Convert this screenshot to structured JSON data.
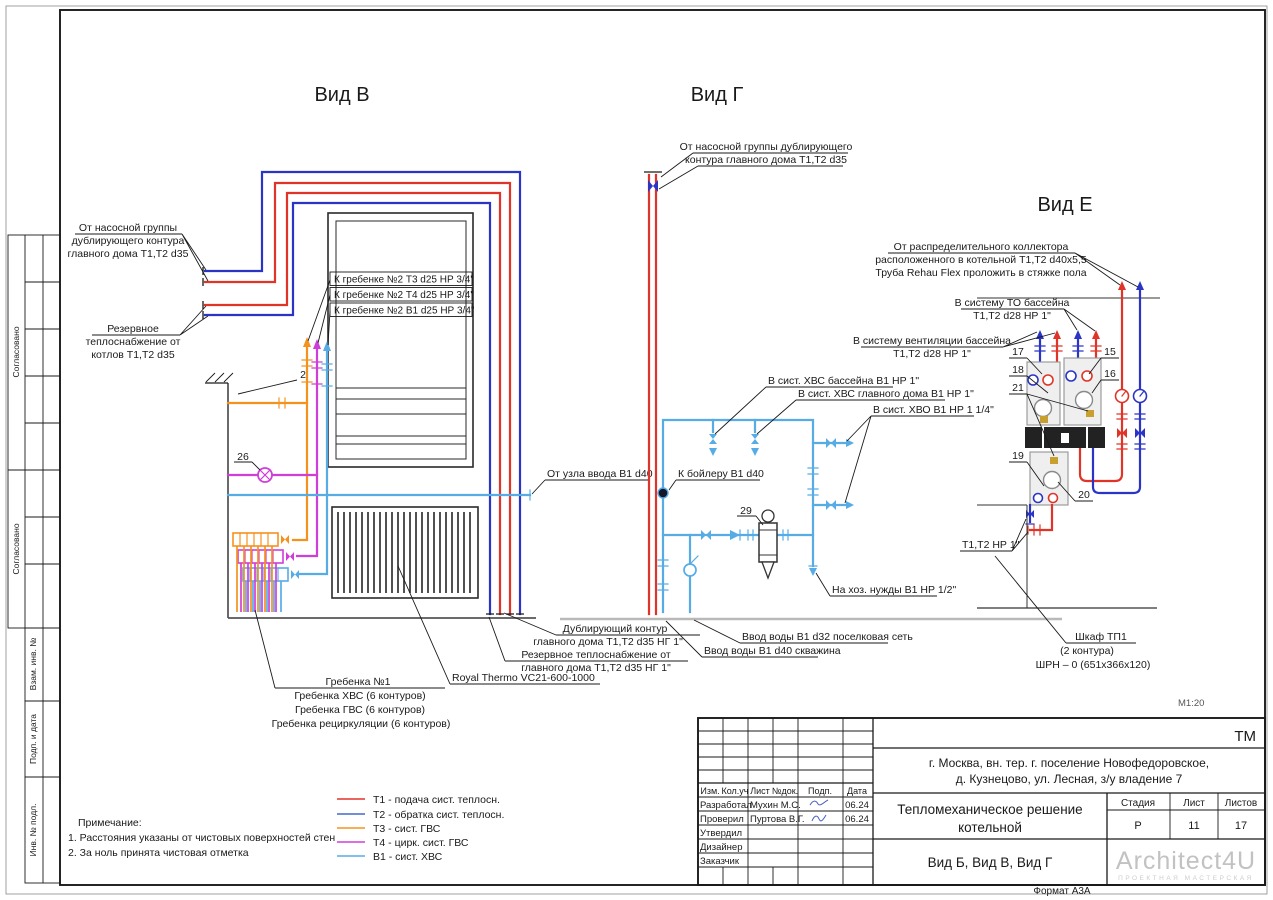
{
  "sheet": {
    "scale_note": "М1:20",
    "format_note": "Формат А3А"
  },
  "sidebar": {
    "agreed1": "Согласовано",
    "agreed2": "Согласовано",
    "vzam": "Взам. инв. №",
    "podp": "Подп. и дата",
    "inv": "Инв. № подл."
  },
  "vid_v": {
    "title": "Вид В",
    "pump_group": [
      "От насосной группы",
      "дублирующего контура",
      "главного дома Т1,Т2 d35"
    ],
    "reserve_boilers": [
      "Резервное",
      "теплоснабжение от",
      "котлов Т1,Т2 d35"
    ],
    "greb_t3": "К гребенке №2 Т3 d25 НР 3/4\"",
    "greb_t4": "К гребенке №2 Т4 d25 НР 3/4\"",
    "greb_b1": "К гребенке №2 В1 d25 НР 3/4\"",
    "num_wall": "2",
    "num_pump": "26",
    "uzel": "От узла ввода В1 d40",
    "dubl": [
      "Дублирующий контур",
      "главного дома Т1,Т2 d35 НГ 1\""
    ],
    "reserve_main": [
      "Резервное теплоснабжение от",
      "главного дома Т1,Т2 d35 НГ 1\""
    ],
    "radiator": "Royal Thermo VC21-600-1000",
    "manifold": [
      "Гребенка №1",
      "Гребенка ХВС (6 контуров)",
      "Гребенка ГВС (6 контуров)",
      "Гребенка рециркуляции (6 контуров)"
    ]
  },
  "vid_g": {
    "title": "Вид Г",
    "from_pump": [
      "От насосной группы дублирующего",
      "контура главного дома Т1,Т2 d35"
    ],
    "hvs_pool": "В сист. ХВС бассейна В1 НР 1\"",
    "hvs_main": "В сист. ХВС главного дома В1 НР 1\"",
    "hvo": "В сист. ХВО В1 НР 1 1/4\"",
    "boiler": "К бойлеру В1 d40",
    "num_filter": "29",
    "hoz": "На хоз. нужды В1 НР 1/2\"",
    "vvod_d32": "Ввод воды В1 d32 поселковая сеть",
    "vvod_d40": "Ввод воды В1 d40 скважина"
  },
  "vid_e": {
    "title": "Вид Е",
    "collector": [
      "От распределительного коллектора",
      "расположенного в котельной Т1,Т2 d40х5,5",
      "Труба Rehau Flex проложить в стяжке пола"
    ],
    "to_pool": [
      "В систему ТО бассейна",
      "Т1,Т2 d28 НР 1\""
    ],
    "vent_pool": [
      "В систему вентиляции бассейна",
      "Т1,Т2 d28 НР 1\""
    ],
    "n15": "15",
    "n16": "16",
    "n17": "17",
    "n18": "18",
    "n19": "19",
    "n20": "20",
    "n21": "21",
    "t1t2": "Т1,Т2 НР 1\"",
    "shkaf": [
      "Шкаф ТП1",
      "(2 контура)",
      "ШРН – 0 (651х366х120)"
    ]
  },
  "legend": {
    "items": [
      {
        "color": "#e03428",
        "text": "Т1 - подача сист. теплосн."
      },
      {
        "color": "#4768c8",
        "text": "Т2 - обратка сист. теплосн."
      },
      {
        "color": "#f5921e",
        "text": "Т3 - сист. ГВС"
      },
      {
        "color": "#cf3fd8",
        "text": "Т4 - цирк. сист. ГВС"
      },
      {
        "color": "#58ace6",
        "text": "В1 - сист. ХВС"
      }
    ]
  },
  "notes": {
    "heading": "Примечание:",
    "line1": "1. Расстояния указаны от чистовых поверхностей стен",
    "line2": "2. За ноль принята чистовая отметка"
  },
  "titleblock": {
    "code": "ТМ",
    "address": [
      "г. Москва, вн. тер. г. поселение Новофедоровское,",
      "д. Кузнецово, ул. Лесная, з/у владение 7"
    ],
    "doc_title": [
      "Тепломеханическое решение",
      "котельной"
    ],
    "sheet_title": "Вид Б, Вид В, Вид Г",
    "cols": {
      "izm": "Изм.",
      "koluch": "Кол.уч",
      "list": "Лист",
      "ndok": "№док.",
      "podp": "Подп.",
      "data": "Дата"
    },
    "rows": [
      {
        "role": "Разработал",
        "name": "Мухин М.С.",
        "date": "06.24"
      },
      {
        "role": "Проверил",
        "name": "Пуртова В.Г.",
        "date": "06.24"
      },
      {
        "role": "Утвердил",
        "name": "",
        "date": ""
      },
      {
        "role": "Дизайнер",
        "name": "",
        "date": ""
      },
      {
        "role": "Заказчик",
        "name": "",
        "date": ""
      }
    ],
    "stage_h": {
      "stage": "Стадия",
      "list": "Лист",
      "listov": "Листов"
    },
    "stage_v": {
      "stage": "Р",
      "list": "11",
      "listov": "17"
    },
    "logo": "Architect4U",
    "logo_sub": "ПРОЕКТНАЯ МАСТЕРСКАЯ"
  },
  "colors": {
    "t1": "#e03428",
    "t2": "#2b35c5",
    "t3": "#f5921e",
    "t4": "#cf3fd8",
    "b1": "#58ace6"
  }
}
